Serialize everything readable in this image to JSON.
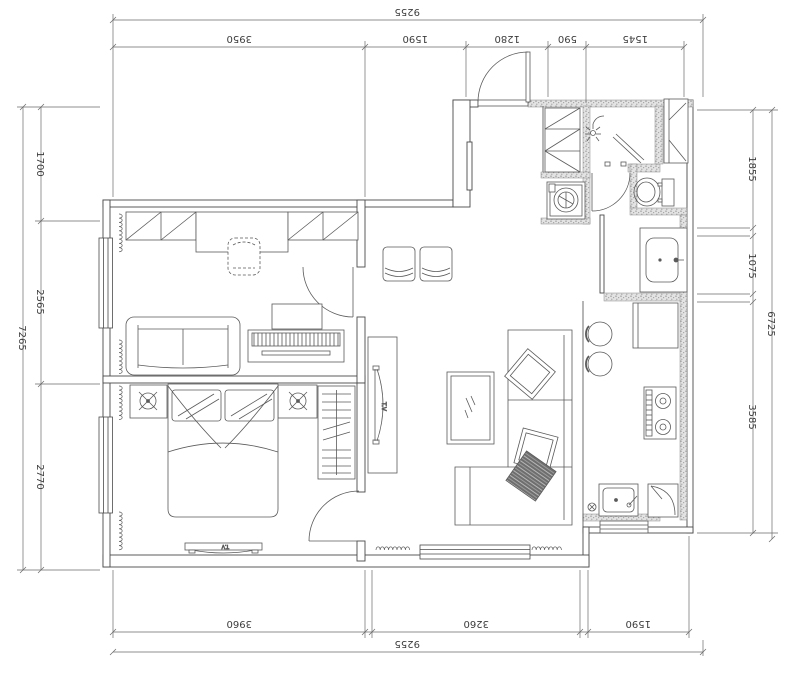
{
  "drawing": {
    "type": "floor-plan",
    "tv_label_living": "T.V",
    "tv_label_bedroom": "T.V"
  },
  "dimensions": {
    "top": {
      "overall": "9255",
      "segments": [
        "3950",
        "1590",
        "1280",
        "590",
        "1545"
      ]
    },
    "bottom": {
      "overall": "9255",
      "segments": [
        "3960",
        "3260",
        "1590"
      ]
    },
    "left": {
      "overall": "7265",
      "segments": [
        "1700",
        "2565",
        "2770"
      ]
    },
    "right": {
      "overall": "6725",
      "segments": [
        "1855",
        "1075",
        "3585"
      ]
    }
  },
  "colors": {
    "line": "#4a4a4a",
    "dim_text": "#3c3c3c",
    "wall_hatch": "#e3e3e3",
    "background": "#ffffff",
    "dark_pillow": "#6e6e6e"
  }
}
